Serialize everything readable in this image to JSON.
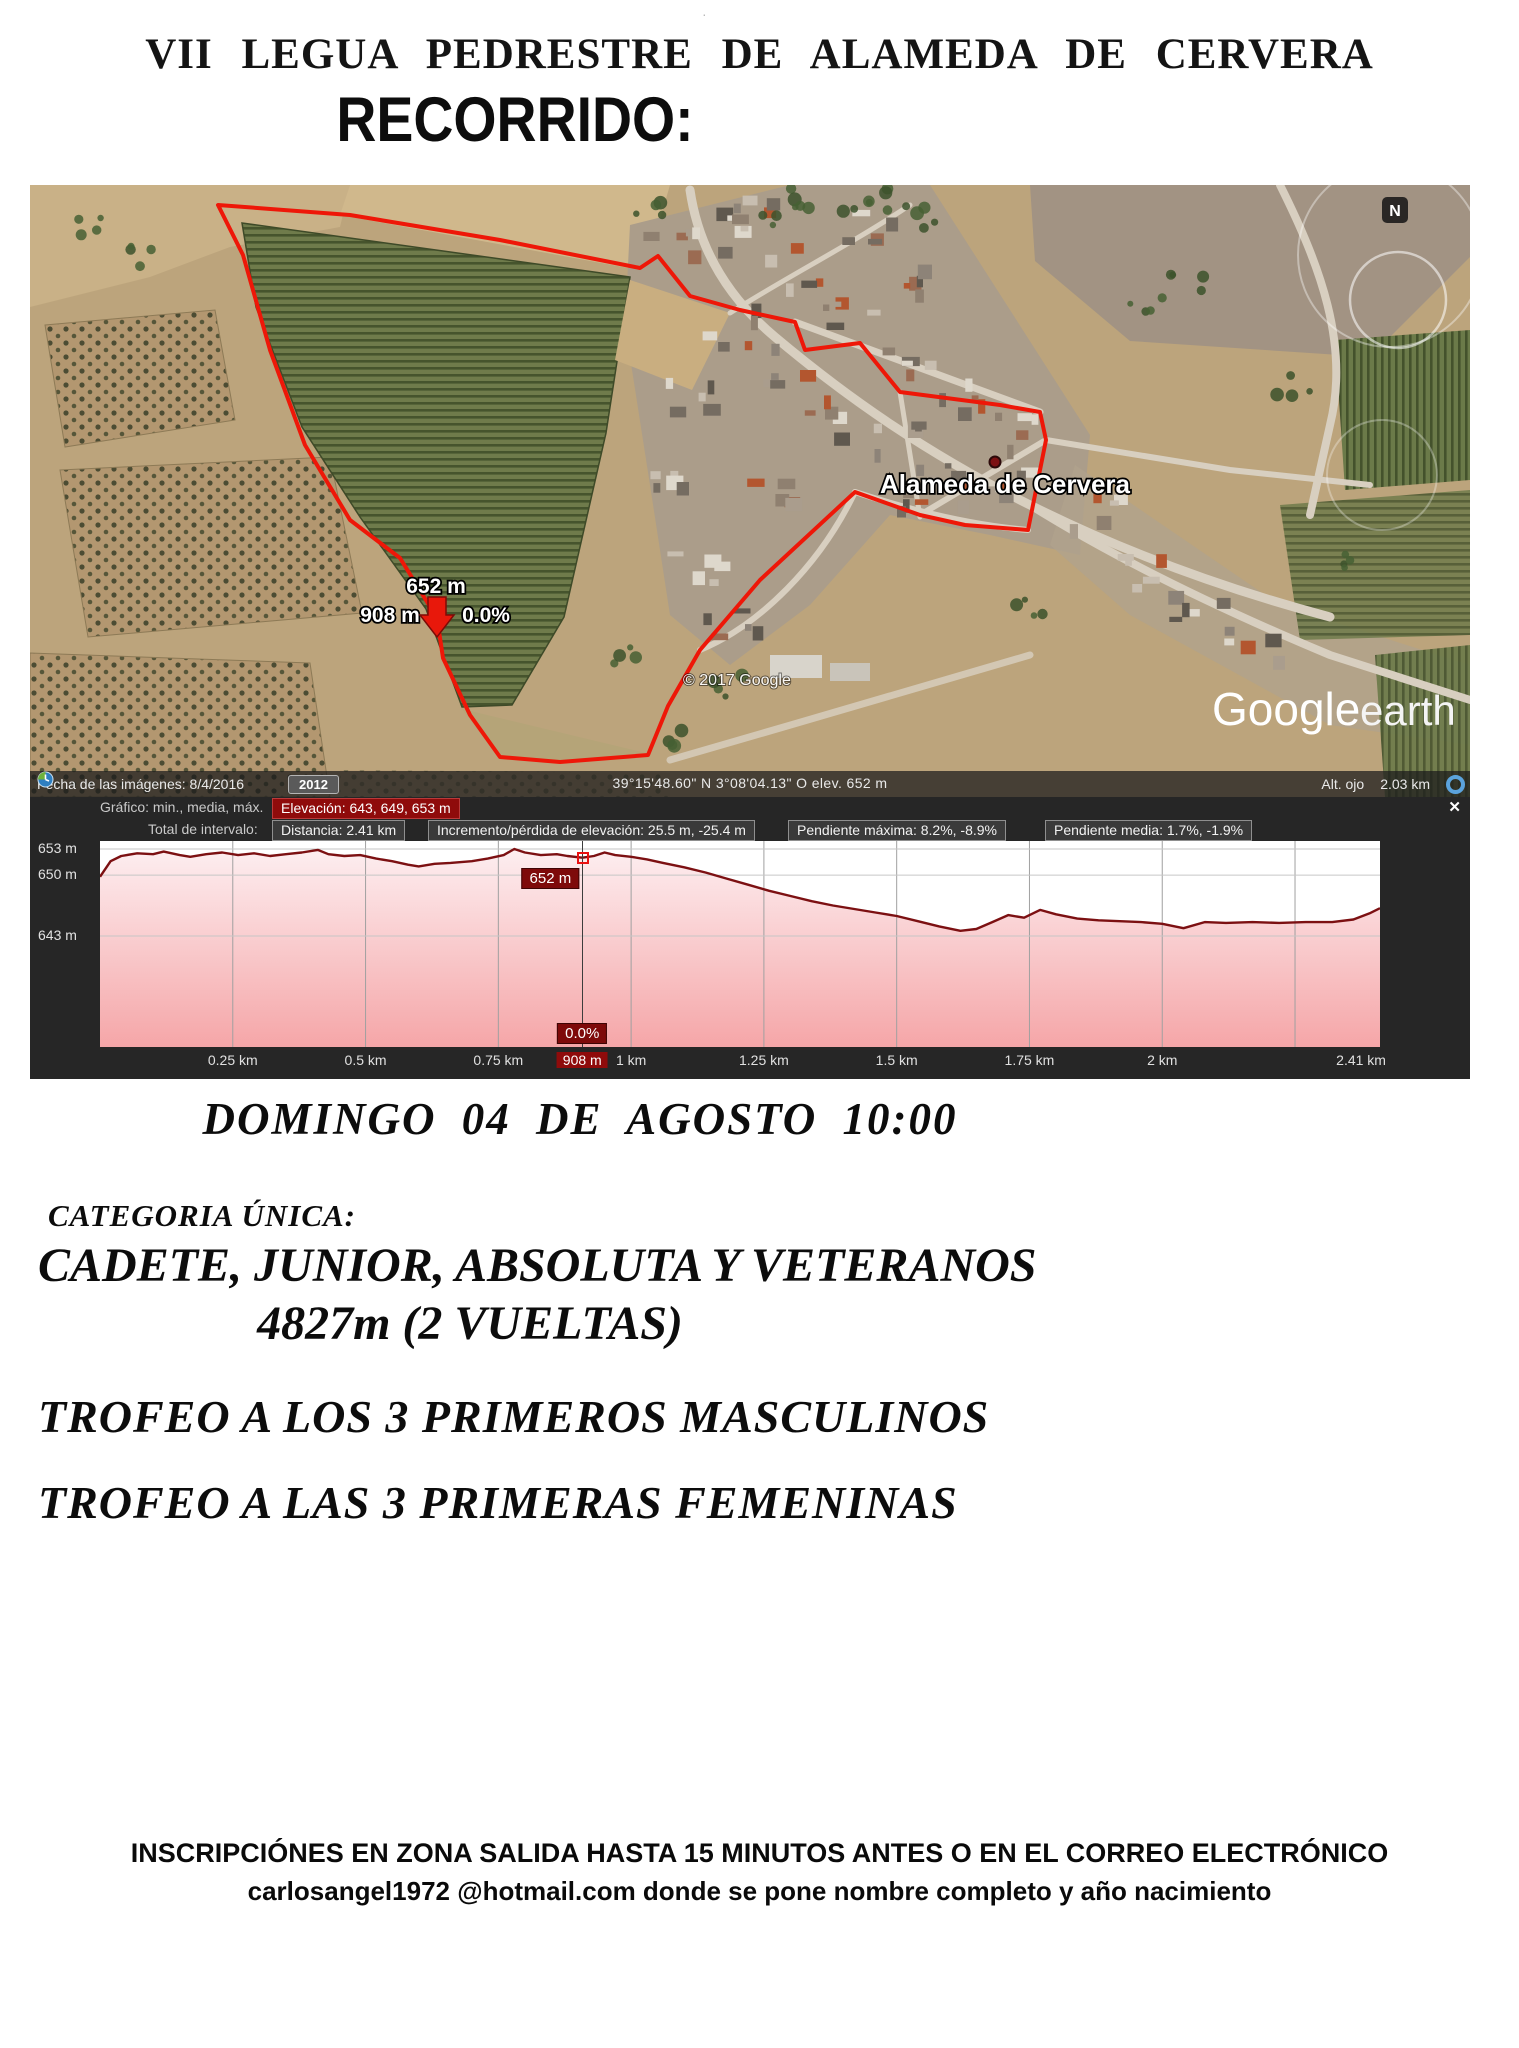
{
  "poster": {
    "title": "VII LEGUA PEDRESTRE DE ALAMEDA DE CERVERA",
    "subtitle": "RECORRIDO:",
    "date_line": "DOMINGO  04 DE AGOSTO  10:00",
    "category_label": "CATEGORIA ÚNICA:",
    "category_line": "CADETE, JUNIOR, ABSOLUTA Y VETERANOS",
    "distance_line": "4827m  (2 VUELTAS)",
    "trophy_men": "TROFEO A LOS 3 PRIMEROS MASCULINOS",
    "trophy_women": "TROFEO A LAS 3 PRIMERAS FEMENINAS",
    "inscription_line1": "INSCRIPCIÓNES EN ZONA SALIDA HASTA 15 MINUTOS ANTES O EN EL CORREO ELECTRÓNICO",
    "inscription_line2": "carlosangel1972 @hotmail.com donde se pone nombre completo y año nacimiento",
    "stray_mark": "·"
  },
  "map": {
    "place_label": "Alameda de Cervera",
    "north_indicator": "N",
    "copyright": "© 2017 Google",
    "logo_google": "Google",
    "logo_earth": "earth",
    "route_marker": {
      "elevation": "652 m",
      "distance": "908 m",
      "slope": "0.0%"
    },
    "status_bar": {
      "imagery_date": "Fecha de las imágenes:  8/4/2016",
      "year_button": "2012",
      "coordinates": "39°15'48.60\" N   3°08'04.13\" O   elev.   652 m",
      "eye_alt_label": "Alt. ojo",
      "eye_alt_value": "2.03 km"
    }
  },
  "elevation_panel": {
    "graph_label": "Gráfico: min., media, máx.",
    "elevation_badge": "Elevación: 643, 649, 653 m",
    "interval_label": "Total de intervalo:",
    "stat_distance": "Distancia: 2.41 km",
    "stat_gain": "Incremento/pérdida de elevación: 25.5 m, -25.4 m",
    "stat_max_slope": "Pendiente máxima: 8.2%, -8.9%",
    "stat_avg_slope": "Pendiente media: 1.7%, -1.9%",
    "close_icon": "✕",
    "marker": {
      "elevation": "652 m",
      "slope": "0.0%",
      "distance_label": "908 m",
      "km": 0.908
    }
  },
  "chart_data": {
    "type": "area",
    "title": "",
    "xlabel": "",
    "ylabel": "",
    "xlim": [
      0,
      2.41
    ],
    "grid": true,
    "y_gridlines": [
      653,
      650,
      643
    ],
    "y_ticks": [
      {
        "label": "653 m",
        "m": 653
      },
      {
        "label": "650 m",
        "m": 650
      },
      {
        "label": "643 m",
        "m": 643
      }
    ],
    "x_ticks": [
      {
        "label": "0.25 km",
        "km": 0.25
      },
      {
        "label": "0.5 km",
        "km": 0.5
      },
      {
        "label": "0.75 km",
        "km": 0.75
      },
      {
        "label": "1 km",
        "km": 1.0
      },
      {
        "label": "1.25 km",
        "km": 1.25
      },
      {
        "label": "1.5 km",
        "km": 1.5
      },
      {
        "label": "1.75 km",
        "km": 1.75
      },
      {
        "label": "2 km",
        "km": 2.0
      },
      {
        "label": "2.41 km",
        "km": 2.41
      }
    ],
    "x": [
      0.0,
      0.02,
      0.04,
      0.07,
      0.1,
      0.12,
      0.15,
      0.17,
      0.2,
      0.23,
      0.26,
      0.29,
      0.32,
      0.35,
      0.38,
      0.41,
      0.43,
      0.46,
      0.49,
      0.52,
      0.55,
      0.58,
      0.6,
      0.63,
      0.66,
      0.7,
      0.73,
      0.76,
      0.78,
      0.8,
      0.83,
      0.86,
      0.88,
      0.908,
      0.93,
      0.95,
      0.97,
      1.0,
      1.03,
      1.06,
      1.1,
      1.14,
      1.18,
      1.22,
      1.26,
      1.3,
      1.34,
      1.38,
      1.42,
      1.46,
      1.5,
      1.54,
      1.58,
      1.62,
      1.65,
      1.68,
      1.71,
      1.74,
      1.77,
      1.8,
      1.84,
      1.88,
      1.92,
      1.96,
      2.0,
      2.04,
      2.08,
      2.12,
      2.17,
      2.22,
      2.27,
      2.32,
      2.36,
      2.39,
      2.41
    ],
    "elevation": [
      649.8,
      651.6,
      652.2,
      652.5,
      652.4,
      652.7,
      652.3,
      652.1,
      652.4,
      652.6,
      652.3,
      652.5,
      652.2,
      652.4,
      652.6,
      652.9,
      652.4,
      652.2,
      652.3,
      651.9,
      651.6,
      651.2,
      651.0,
      651.3,
      651.4,
      651.6,
      651.9,
      652.3,
      653.0,
      652.6,
      652.3,
      652.4,
      652.2,
      652.0,
      652.2,
      652.6,
      652.3,
      652.1,
      651.8,
      651.4,
      650.9,
      650.3,
      649.6,
      648.9,
      648.2,
      647.6,
      647.0,
      646.5,
      646.1,
      645.7,
      645.3,
      644.7,
      644.1,
      643.6,
      643.8,
      644.6,
      645.4,
      645.1,
      646.0,
      645.5,
      645.0,
      644.8,
      644.7,
      644.6,
      644.4,
      643.9,
      644.6,
      644.5,
      644.6,
      644.5,
      644.6,
      644.6,
      644.9,
      645.6,
      646.2
    ],
    "stats": {
      "min_m": 643,
      "mean_m": 649,
      "max_m": 653,
      "distance_km": 2.41,
      "gain_m": 25.5,
      "loss_m": -25.4,
      "max_slope_pct": 8.2,
      "max_neg_slope_pct": -8.9,
      "avg_slope_pct": 1.7,
      "avg_neg_slope_pct": -1.9
    },
    "marker": {
      "km": 0.908,
      "elevation_m": 652,
      "slope_pct": 0.0
    },
    "colors": {
      "line": "#7c1012",
      "fill_top": "#fdeef0",
      "fill_bottom": "#f5a6a8",
      "accent": "#8f0b0b"
    }
  }
}
